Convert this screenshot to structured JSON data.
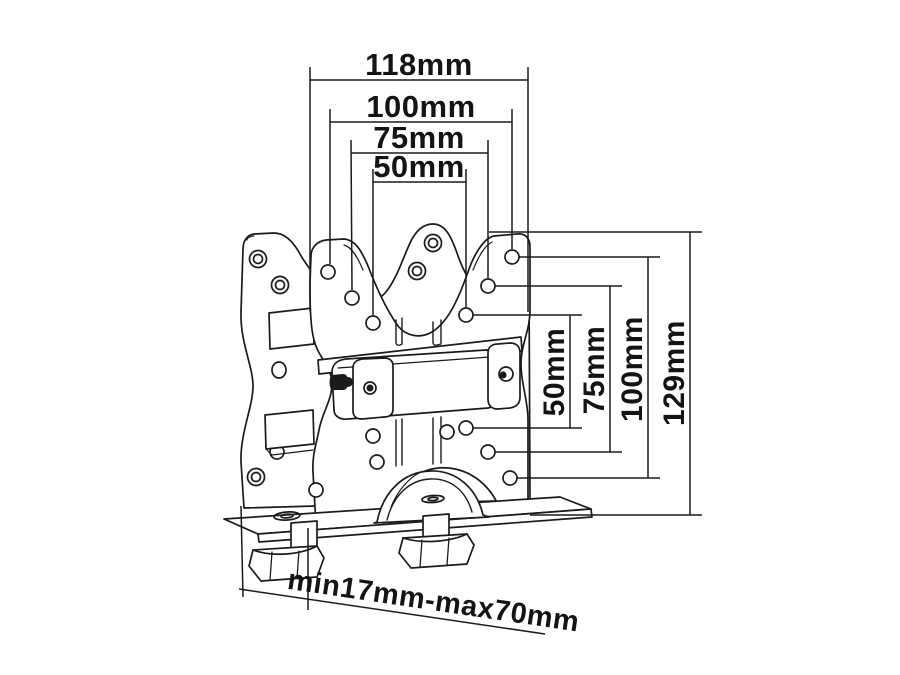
{
  "style": {
    "background": "#ffffff",
    "line_color": "#1b1b1b",
    "text_color": "#141414"
  },
  "drawing": {
    "subject": "monitor-bracket-technical-drawing"
  },
  "dimensions": {
    "top": [
      {
        "label": "118mm"
      },
      {
        "label": "100mm"
      },
      {
        "label": "75mm"
      },
      {
        "label": "50mm"
      }
    ],
    "right": [
      {
        "label": "50mm"
      },
      {
        "label": "75mm"
      },
      {
        "label": "100mm"
      },
      {
        "label": "129mm"
      }
    ],
    "bottom": {
      "label": "min17mm-max70mm"
    }
  }
}
